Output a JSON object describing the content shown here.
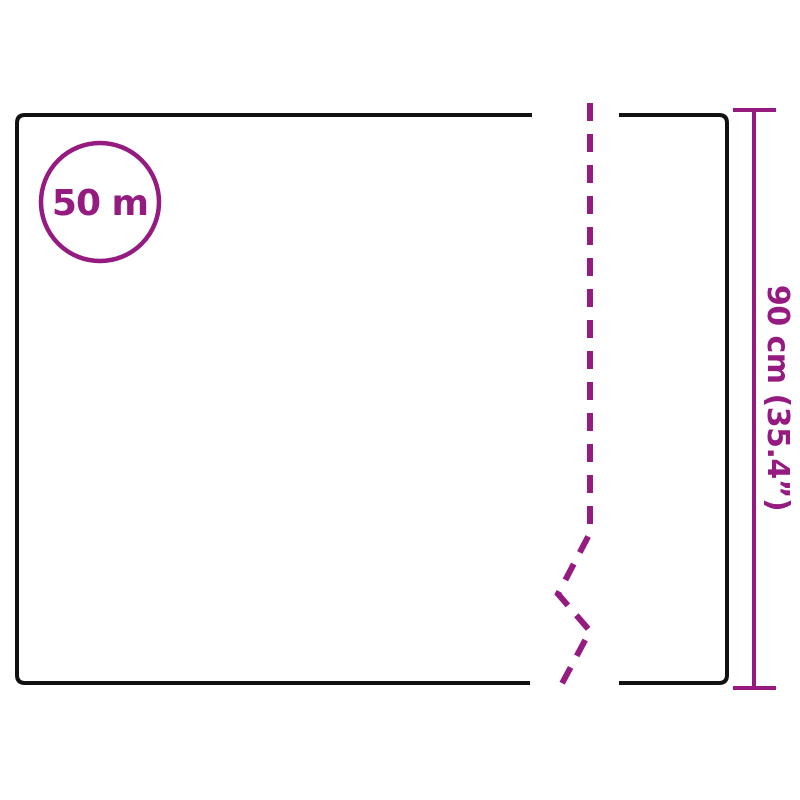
{
  "page": {
    "background": "#FFFFFF",
    "type": "product-dimension-diagram"
  },
  "diagram": {
    "length_badge": {
      "label": "50 m"
    },
    "height_dimension": {
      "label": "90 cm (35.4”)"
    },
    "colors": {
      "accent": "#951B81",
      "outline": "#111111"
    }
  }
}
